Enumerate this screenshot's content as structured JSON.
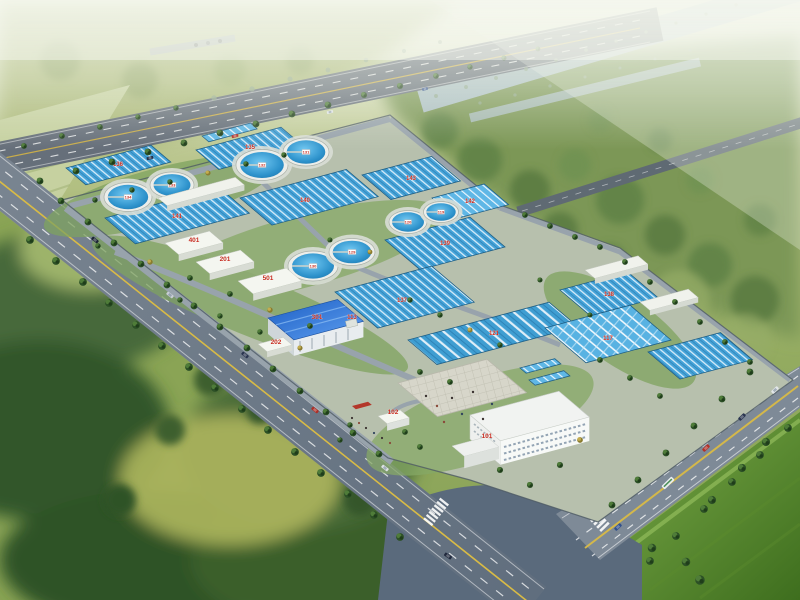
{
  "scene": {
    "description": "Aerial rendering of a wastewater treatment plant campus bounded by tree-lined roads, with rectangular aeration basins, circular clarifier tanks, a blue-roofed workshop, an administration building with plaza, and a gate house",
    "setting": "hazy green hills and a river at the top, forest at lower left, farm field at lower right, road intersection with crosswalks at bottom"
  },
  "colors": {
    "label_red": "#c62b1e",
    "basin_water": "#45a3d8",
    "tank_water": "#2187c4",
    "roof_blue": "#2e6fd0",
    "road_gray": "#6b7682",
    "field_green": "#5d8a33",
    "forest_green": "#3a5a2c",
    "haze": "#f3f6ea"
  },
  "labels": {
    "tanks": {
      "a1": "132",
      "a2": "131",
      "b1": "134",
      "b2": "133",
      "c1": "130",
      "c2": "129",
      "c3": "120",
      "c4": "119"
    },
    "basins": {
      "t1": "136",
      "t2": "135",
      "t3": "143",
      "tr": "142",
      "m1": "141",
      "m2": "140",
      "m3": "139",
      "m4": "138",
      "bo1": "137",
      "bo2": "121",
      "bo3": "117",
      "small": "113"
    },
    "buildings": {
      "admin": "101",
      "gate": "102",
      "annex": "202",
      "workshop": "301",
      "store": "401",
      "lab": "201",
      "aux": "501"
    }
  }
}
